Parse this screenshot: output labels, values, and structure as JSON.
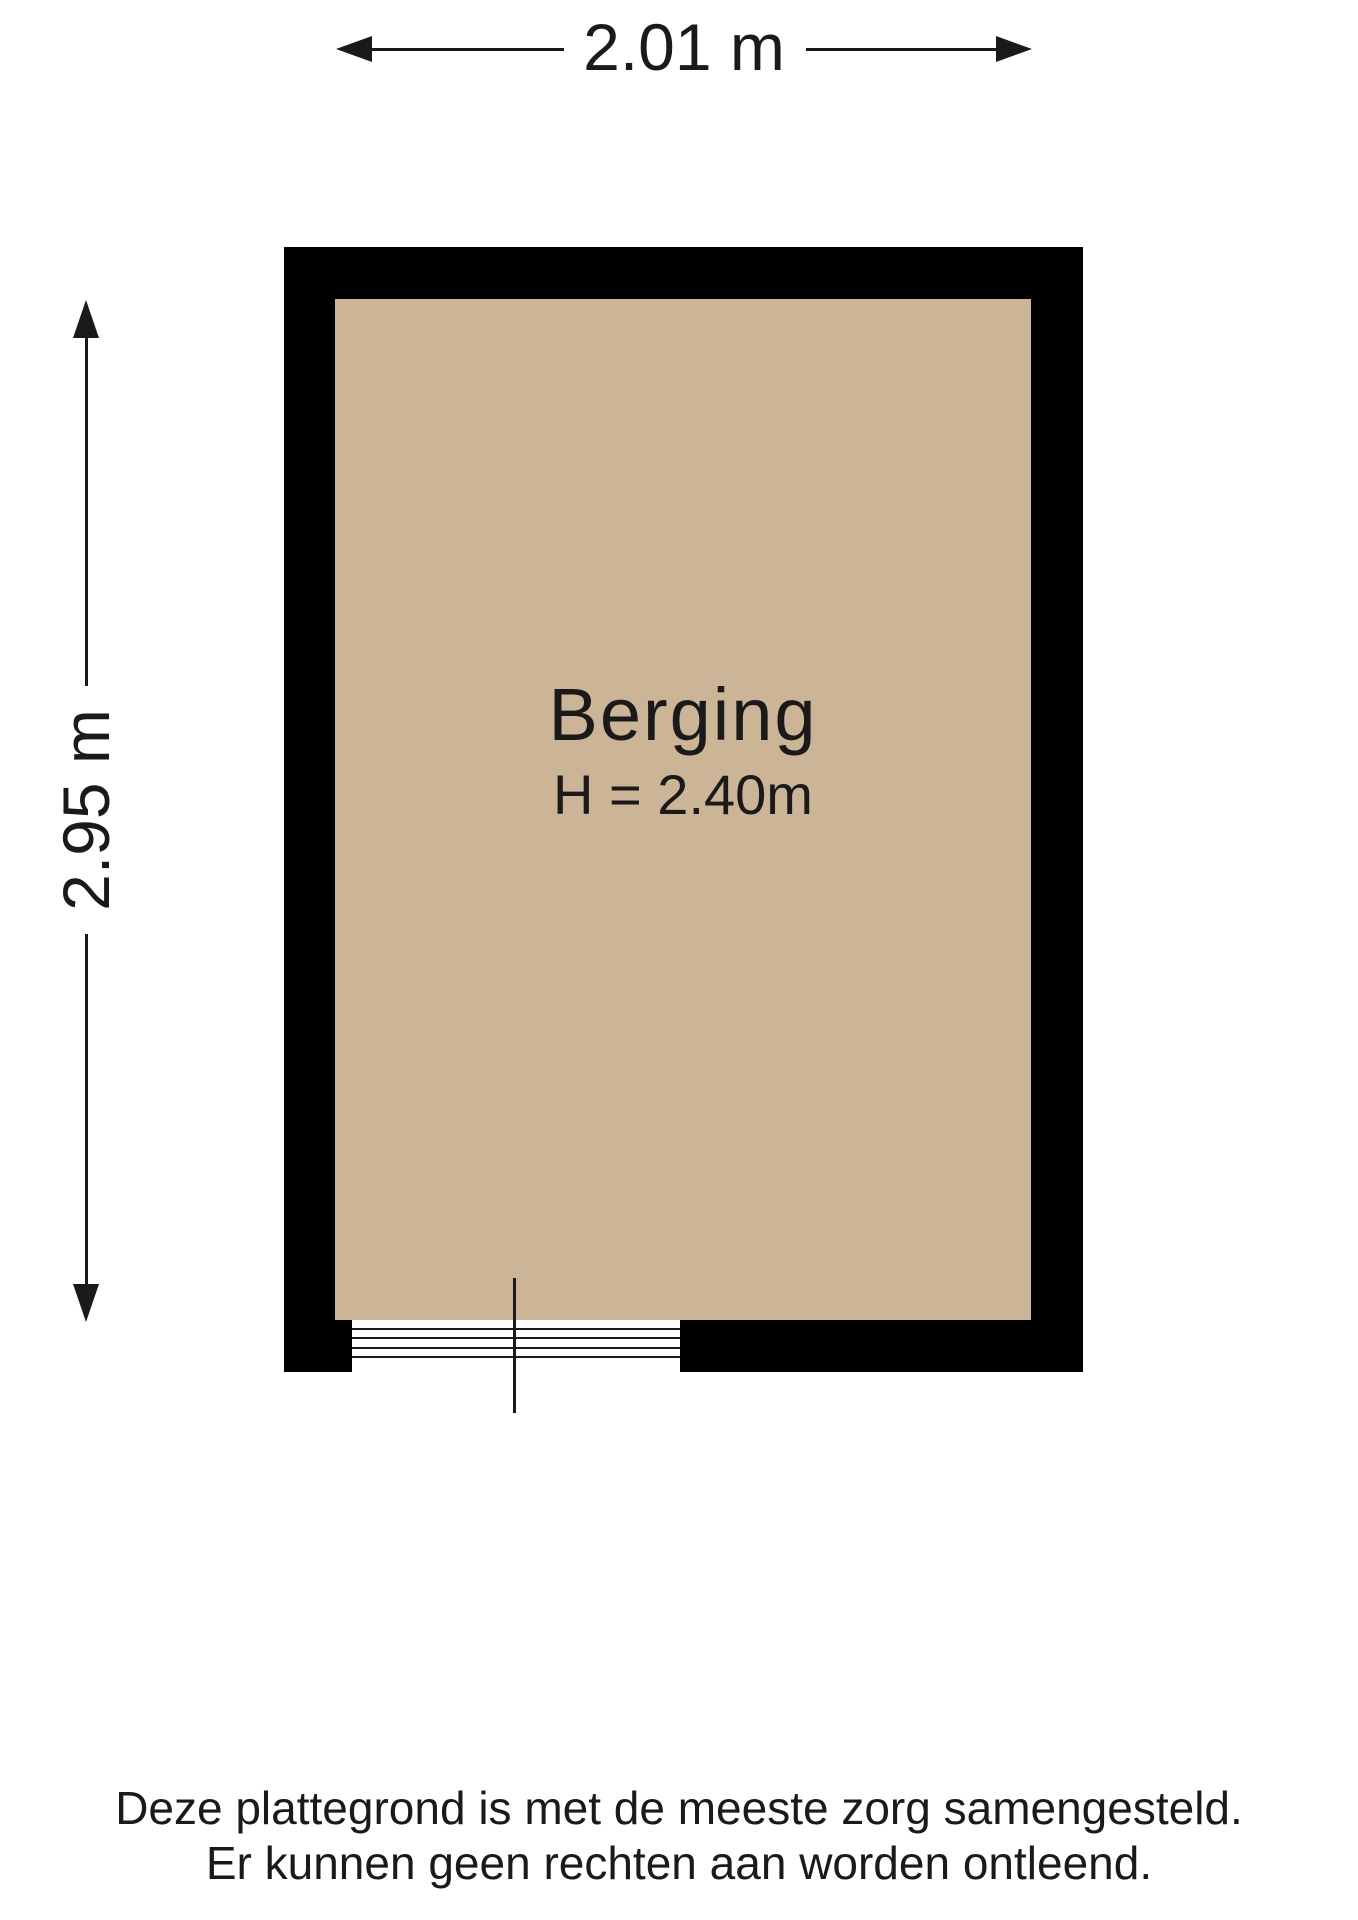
{
  "floorplan": {
    "room": {
      "name": "Berging",
      "ceiling_height_label": "H = 2.40m"
    },
    "dimensions": {
      "width_label": "2.01 m",
      "height_label": "2.95 m"
    },
    "disclaimer": {
      "line1": "Deze plattegrond is met de meeste zorg samengesteld.",
      "line2": "Er kunnen geen rechten aan worden ontleend."
    },
    "icons": {
      "width_left": "arrow-left-icon",
      "width_right": "arrow-right-icon",
      "height_up": "arrow-up-icon",
      "height_down": "arrow-down-icon"
    },
    "colors": {
      "wall": "#000000",
      "floor": "#ccb496",
      "background": "#ffffff",
      "text": "#1a1a1a"
    }
  }
}
